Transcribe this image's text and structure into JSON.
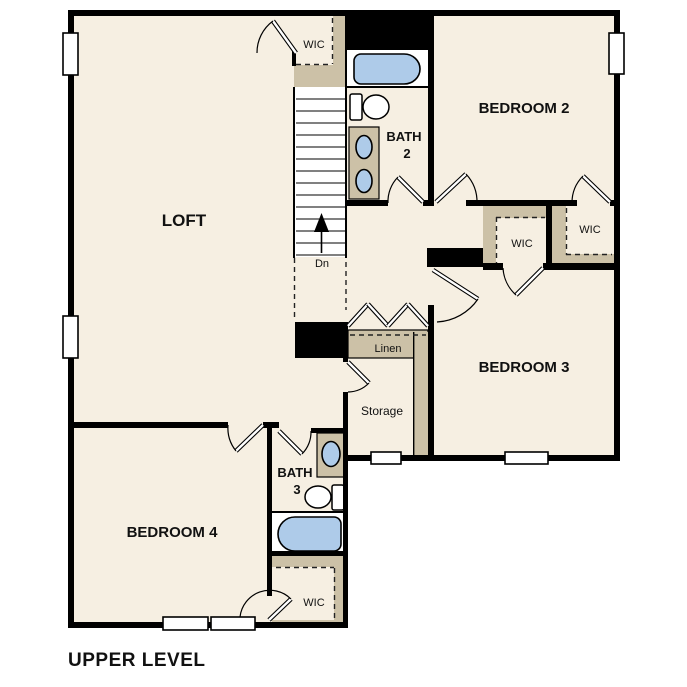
{
  "palette": {
    "background": "#ffffff",
    "room_fill": "#f6efe2",
    "closet_shelf_tan": "#ccc1a7",
    "fixture_blue": "#aecbe9",
    "wall_black": "#000000"
  },
  "rooms": {
    "loft": {
      "label": "LOFT"
    },
    "bedroom2": {
      "label": "BEDROOM 2"
    },
    "bedroom3": {
      "label": "BEDROOM 3"
    },
    "bedroom4": {
      "label": "BEDROOM 4"
    },
    "bath2": {
      "line1": "BATH",
      "line2": "2"
    },
    "bath3": {
      "line1": "BATH",
      "line2": "3"
    },
    "wic_loft": {
      "label": "WIC"
    },
    "wic_bedroom2": {
      "label": "WIC"
    },
    "wic_bedroom3": {
      "label": "WIC"
    },
    "wic_bedroom4": {
      "label": "WIC"
    },
    "linen": {
      "label": "Linen"
    },
    "storage": {
      "label": "Storage"
    }
  },
  "stairs": {
    "down_label": "Dn"
  },
  "fixtures": {
    "bath2": [
      "bathtub-icon",
      "toilet-icon",
      "double-sink-vanity-icon"
    ],
    "bath3": [
      "sink-vanity-icon",
      "toilet-icon",
      "bathtub-icon"
    ]
  },
  "footer": {
    "level_label": "UPPER LEVEL"
  }
}
